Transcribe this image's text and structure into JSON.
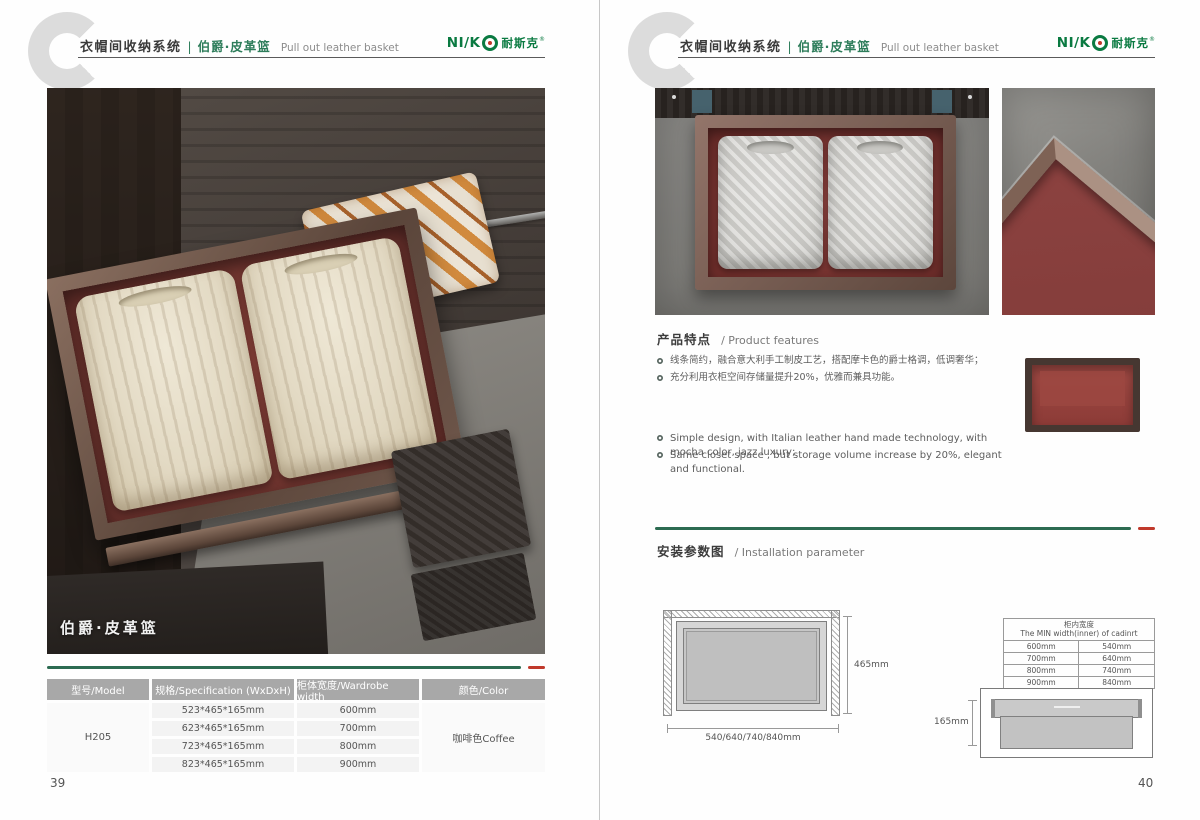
{
  "colors": {
    "accent_green": "#2c6b51",
    "accent_red": "#c0392b",
    "logo_green": "#0a7a41",
    "table_header_bg": "#a8a8a8"
  },
  "header": {
    "title_cn": "衣帽间收纳系统",
    "divider": "|",
    "subtitle_cn": "伯爵·皮革篮",
    "subtitle_en": "Pull out leather basket",
    "logo": {
      "latin": "NI/K",
      "cn": "耐斯克",
      "reg": "®"
    }
  },
  "left_page": {
    "photo_caption": "伯爵·皮革篮",
    "table": {
      "headers": [
        "型号/Model",
        "规格/Specification (WxDxH)",
        "柜体宽度/Wardrobe width",
        "颜色/Color"
      ],
      "model": "H205",
      "specs": [
        "523*465*165mm",
        "623*465*165mm",
        "723*465*165mm",
        "823*465*165mm"
      ],
      "widths": [
        "600mm",
        "700mm",
        "800mm",
        "900mm"
      ],
      "color": "咖啡色Coffee"
    },
    "page_number": "39"
  },
  "right_page": {
    "features": {
      "title_cn": "产品特点",
      "title_en": "/ Product features",
      "bullets_cn": [
        "线条简约，融合意大利手工制皮工艺，搭配摩卡色的爵士格调，低调奢华；",
        "充分利用衣柜空间存储量提升20%，优雅而兼具功能。"
      ],
      "bullets_en": [
        "Simple design, with Italian leather hand made technology, with mocha color, jazz  luxury;",
        "Same closet space , but storage volume increase by 20%, elegant and functional."
      ]
    },
    "installation": {
      "title_cn": "安装参数图",
      "title_en": "/ Installation parameter",
      "top_view": {
        "height_label": "465mm",
        "width_label": "540/640/740/840mm"
      },
      "min_width_table": {
        "title_cn": "柜内宽度",
        "title_en": "The MIN width(inner) of cadinrt",
        "rows": [
          [
            "600mm",
            "540mm"
          ],
          [
            "700mm",
            "640mm"
          ],
          [
            "800mm",
            "740mm"
          ],
          [
            "900mm",
            "840mm"
          ]
        ]
      },
      "side_view": {
        "height_label": "165mm"
      }
    },
    "page_number": "40"
  }
}
